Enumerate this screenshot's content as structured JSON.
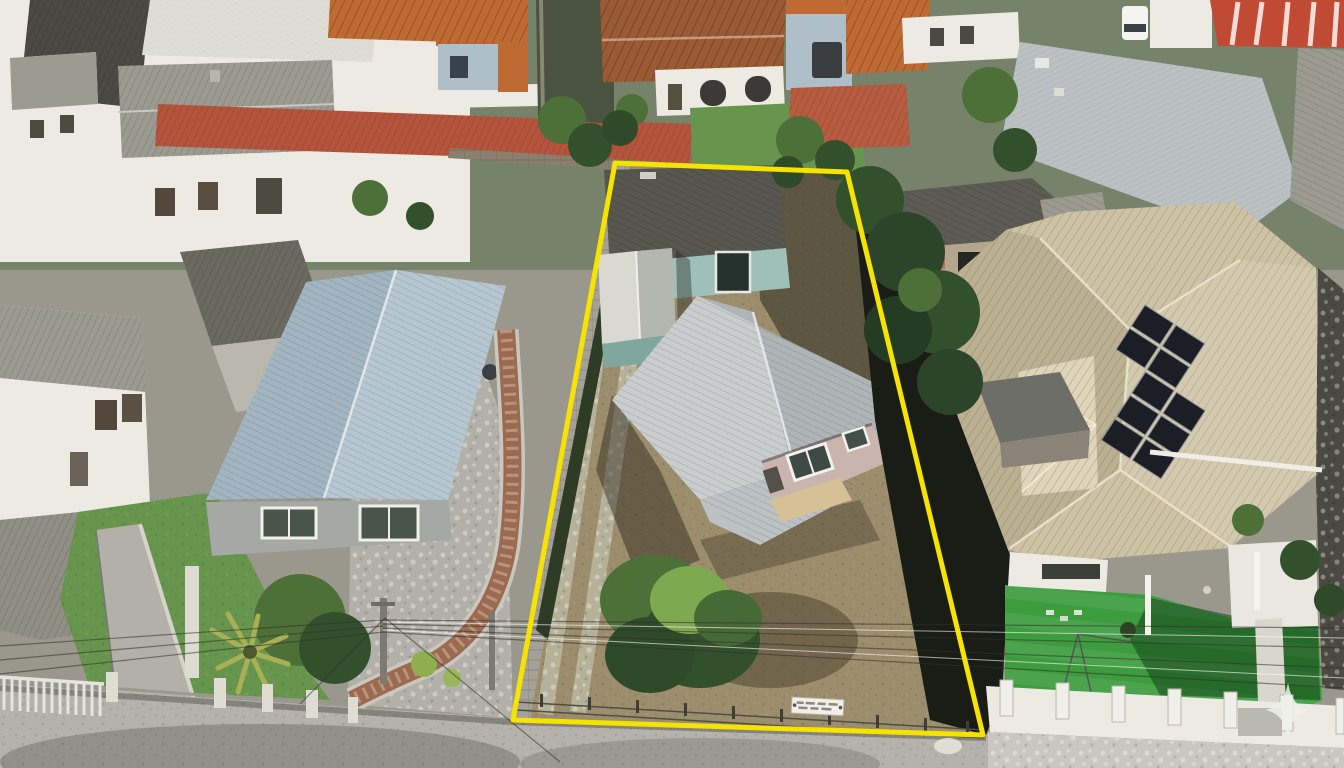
{
  "scene": {
    "type": "aerial-drone-photo",
    "description": "Aerial drone photo of a residential block; center lot outlined in yellow containing a rear teal house, a shed and a silver-roof house on bare dirt; neighbors with orange, gray, blue and cream tile roofs, solar panels, artificial turf and a street along the bottom"
  },
  "boundary": {
    "points": "615,163 847,172 983,735 513,720",
    "color": "#f6e400",
    "stroke_width": 5
  },
  "watermark": {
    "icon": "four-pointed-star-icon",
    "color": "#eef0ea",
    "opacity": 0.85,
    "transform": "translate(1288,710) scale(0.8)"
  },
  "sign": {
    "legible": false,
    "color": "#f1efe8"
  },
  "colors": {
    "base": "#9a988c",
    "topzone": "#77826a",
    "street": "#b4b2ab",
    "sidewalk": "#cac7c0",
    "concrete": "#b2b0a8",
    "dirt": "#9c8d6c",
    "weedy": "#b6b199",
    "lawn": "#67954d",
    "turf": "#3c9c3e",
    "treeDark": "#33502c",
    "treeMid": "#4c7038",
    "treeLight": "#7ea951",
    "palm": "#a9af55",
    "roofOrange": "#c06a33",
    "roofBrownOrange": "#9a5a33",
    "roofRed": "#b5543c",
    "roofSalmon": "#b75b41",
    "stripedRed": "#c14a34",
    "roofSilver": "#c9cdce",
    "roofSilverDark": "#afb5b7",
    "roofMetal": "#b8bdbf",
    "roofBlueLit": "#b7c7d1",
    "roofBlueShade": "#a2b5c1",
    "roofCream": "#cdc2a3",
    "roofCreamLight": "#ded5bb",
    "roofGray": "#9b9b92",
    "roofGray2": "#8f8f86",
    "roofDark": "#4a4a42",
    "roofDark2": "#6a6a61",
    "roofBack": "#57574f",
    "roofDarkGray": "#5c5c55",
    "wallWhite": "#eceae2",
    "wallGray": "#a6a8a6",
    "wallTeal": "#9fc0b8",
    "wallTealDark": "#7fa79e",
    "wallPink": "#c9b5ad",
    "wallTan": "#b3a68d",
    "wallBlue": "#aebfca",
    "boundaryWall": "#a5a196",
    "hedge": "#2e3c26",
    "shadowGap": "#191d15",
    "solar": "#1b1e24",
    "van": "#f4f4f0",
    "fenceWhite": "#eceae3",
    "pillar": "#dedcd3",
    "brick": "#9c6a4f",
    "porchTan": "#d6c096",
    "porchFloor": "#e9e7df",
    "darkStrip": "#4a4a42",
    "pole": "#7c7a72"
  }
}
